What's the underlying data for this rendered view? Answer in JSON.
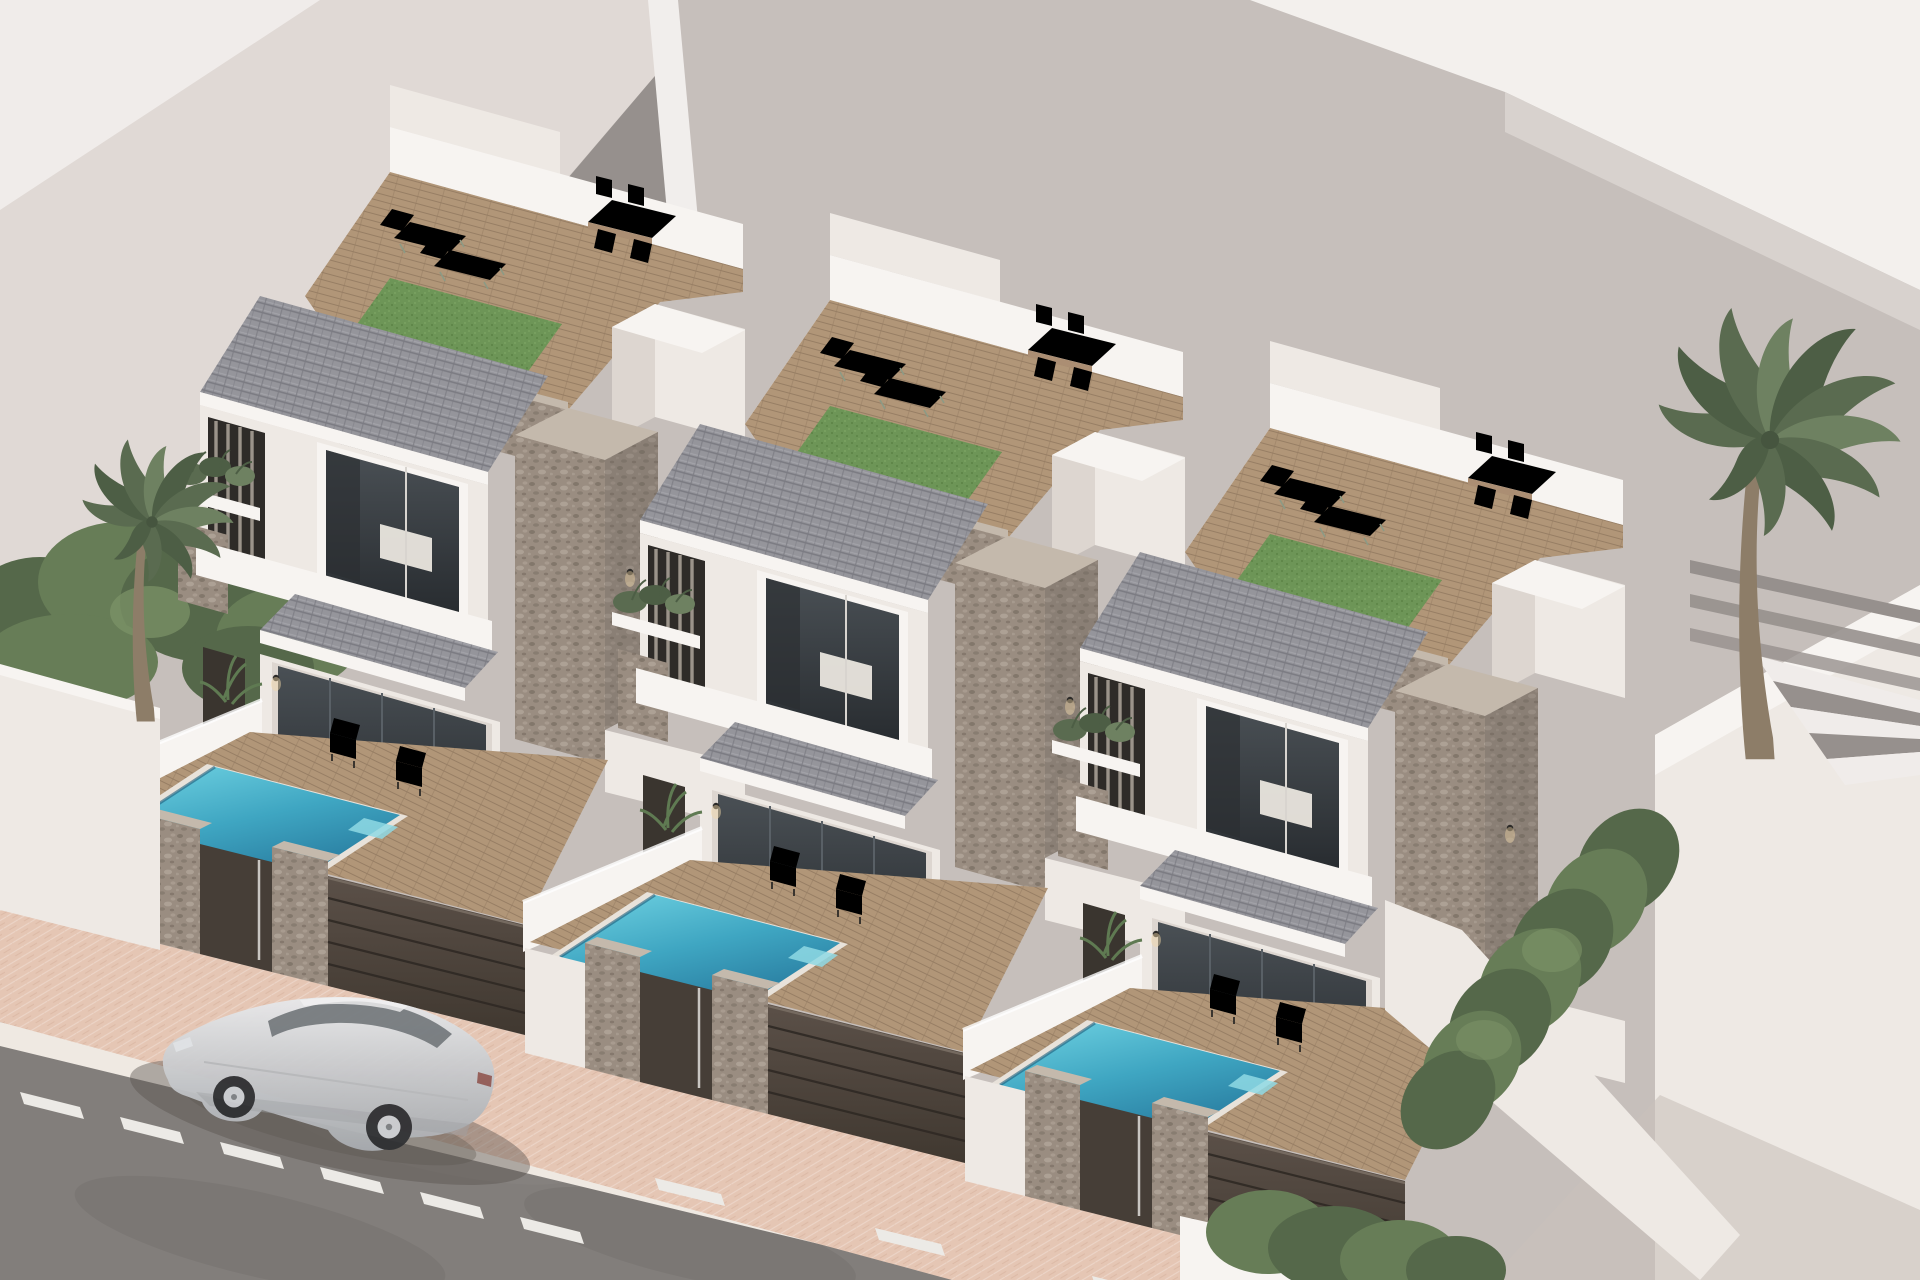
{
  "scene": {
    "type": "architectural-3d-render",
    "subject": "Aerial view of three identical modern white villas, each with a private plunge pool, timber terrace, stone-clad piers, grey tiled roofs and landscaped roof terraces, beside a street with a parked silver SUV",
    "villa_count": 3,
    "pool_count": 3,
    "palm_tree_count": 2,
    "objects": [
      "context-buildings",
      "street",
      "pink-sidewalk",
      "white-curb",
      "dashed-lane-markings",
      "silver-suv",
      "villa",
      "roof-terrace",
      "artificial-turf",
      "sun-loungers",
      "rooftop-dining-set",
      "stone-parapet-band",
      "stone-pier",
      "tiled-roof",
      "window-awning",
      "bedroom-window",
      "sliding-glass-doors",
      "timber-deck",
      "plunge-pool",
      "outdoor-armchairs",
      "potted-plant",
      "louvre-screen",
      "planter-box",
      "dark-metal-fence",
      "stone-fence-pillars",
      "entrance-gate",
      "boundary-walls",
      "palm-tree",
      "hedge-row",
      "pergola-beams",
      "external-stairs",
      "wall-lights"
    ]
  },
  "palette": {
    "bg_base": "#c6bfbb",
    "bg_light": "#e0d9d5",
    "bg_bright": "#f0ecea",
    "bg_dark": "#96908d",
    "bg_edge": "#f1eeec",
    "roof_white": "#f3f0ed",
    "roof_white_shade": "#d8d2ce",
    "wall_bright": "#f7f4f1",
    "wall_lit": "#eee9e4",
    "wall_shade": "#ddd6d0",
    "wall_dark": "#c9c1bb",
    "stone_base": "#9a8d81",
    "stone_dark": "#6f6459",
    "stone_light": "#b5aa9e",
    "stone_cap": "#c4b9ac",
    "roof_base": "#95959b",
    "roof_line": "#7c7c83",
    "roof_light": "#a6a6ac",
    "deck_base": "#b19678",
    "deck_line": "#977e64",
    "turf_base": "#6d9557",
    "turf_dark": "#5b8245",
    "turf_light": "#7ea765",
    "pool_light": "#6fd2e2",
    "pool_mid": "#3fa6c2",
    "pool_deep": "#2a7fa2",
    "pool_coping": "#e8e2da",
    "fence_top": "#5b5048",
    "fence_bottom": "#403830",
    "fence_line": "#2f2924",
    "gate": "#463e37",
    "glass_hi": "#4a5055",
    "glass_lo": "#282c30",
    "interior_warm": "#7b6753",
    "interior_soft": "#efeae3",
    "walk_base": "#e5c6b4",
    "curb": "#efe9e2",
    "road_base": "#827e7b",
    "road_mark": "#eceae6",
    "car_hi": "#e8e9eb",
    "car_mid": "#c3c5c8",
    "car_lo": "#a7aaae",
    "car_glass": "#6f757a",
    "wheel": "#2f3033",
    "rim": "#caccd0",
    "frond_dark": "#4d5e45",
    "frond_mid": "#5a6b50",
    "frond_light": "#6e8161",
    "trunk": "#8d7d68",
    "hedge_dark": "#55684a",
    "hedge_mid": "#677d57",
    "hedge_light": "#7d9468",
    "shadow": "#59524d"
  }
}
